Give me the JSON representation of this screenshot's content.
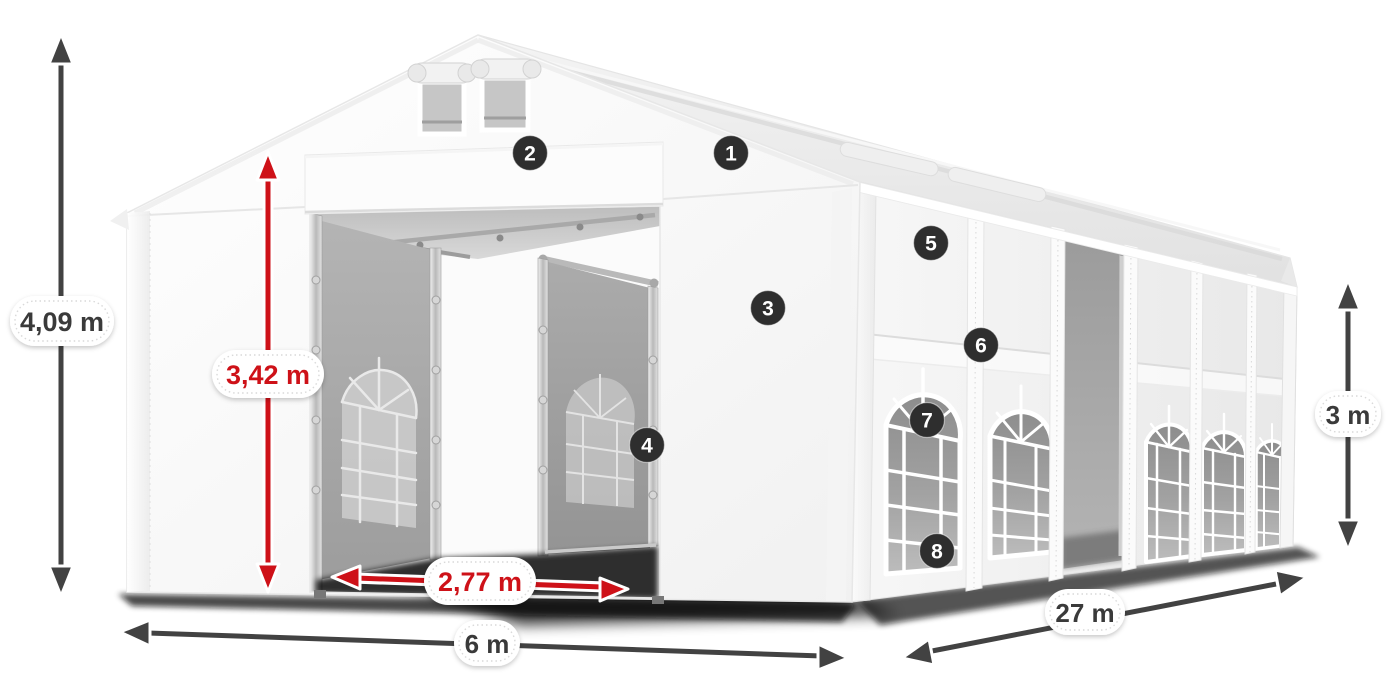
{
  "diagram": {
    "title": "Marquee tent dimension diagram",
    "dimensions": {
      "total_height": {
        "value": "4,09 m",
        "color": "#3a3a3a"
      },
      "entrance_height": {
        "value": "3,42 m",
        "color": "#ce1118"
      },
      "entrance_width": {
        "value": "2,77 m",
        "color": "#ce1118"
      },
      "front_width": {
        "value": "6 m",
        "color": "#3a3a3a"
      },
      "side_length": {
        "value": "27 m",
        "color": "#3a3a3a"
      },
      "side_height": {
        "value": "3 m",
        "color": "#3a3a3a"
      }
    },
    "markers": [
      {
        "number": "1"
      },
      {
        "number": "2"
      },
      {
        "number": "3"
      },
      {
        "number": "4"
      },
      {
        "number": "5"
      },
      {
        "number": "6"
      },
      {
        "number": "7"
      },
      {
        "number": "8"
      }
    ],
    "colors": {
      "dimension_red": "#ce1118",
      "dimension_gray": "#424242",
      "marker_background": "#2e2e2e",
      "tent_white": "#ffffff",
      "glass_gray": "#979797",
      "background": "#ffffff"
    }
  }
}
